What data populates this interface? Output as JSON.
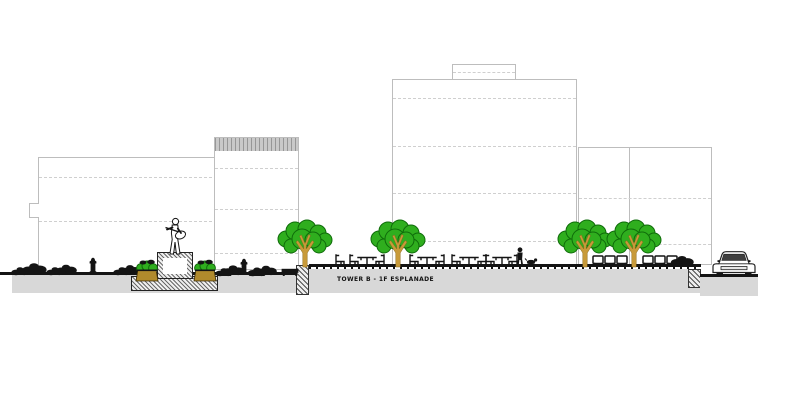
{
  "scene": {
    "type": "architectural-section-elevation",
    "description": "CAD street section / elevation: four light-gray building outlines with dashed floor lines, a raised plaza with cafe tables and chairs, four trees, a guitarist statue on a hatched pedestal flanked by planters, shrubs, two fire hydrants, a pedestrian with a dog, modular cube seating, and a parked car at street level."
  },
  "label": {
    "text": "TOWER B - 1F ESPLANADE"
  },
  "colors": {
    "outline": "#bdbdbd",
    "dash": "#cfcfcf",
    "band": "#c9c9c9",
    "ink": "#141414",
    "gray": "#d8d8d8",
    "foliage": "#2fae1e",
    "foliage_edge": "#0f6b0a",
    "branch": "#c89a3a",
    "pot": "#b08a2c",
    "wall_face": "#ededed"
  },
  "elements": {
    "buildings": 4,
    "trees": 4,
    "shrubs": 11,
    "fire_hydrants": 2,
    "cafe_tables": 4,
    "cafe_chairs": 9,
    "cube_seats": 6,
    "pedestrians": 1,
    "dogs": 1,
    "cars": 1,
    "statues": 1,
    "planters": 2
  }
}
